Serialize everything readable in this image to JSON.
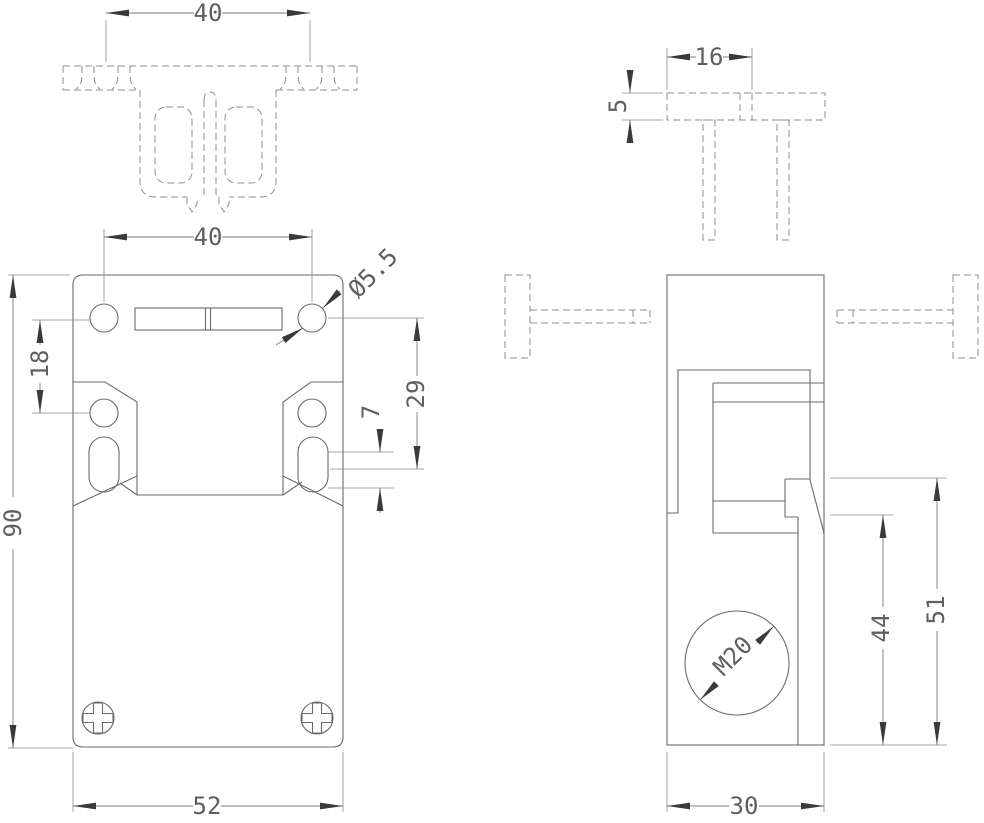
{
  "drawing": {
    "dims": {
      "actuator_width": "40",
      "mount_hole_spacing": "40",
      "mount_hole_dia": "Ø5.5",
      "hole_pair_spacing": "18",
      "body_height": "90",
      "slot_center_from_hole": "29",
      "slot_height": "7",
      "body_width": "52",
      "actuator_hole_offset": "16",
      "actuator_plate_thickness": "5",
      "lever_step_to_base": "44",
      "slot_face_to_base": "51",
      "conduit_thread": "M20",
      "body_depth": "30"
    }
  }
}
